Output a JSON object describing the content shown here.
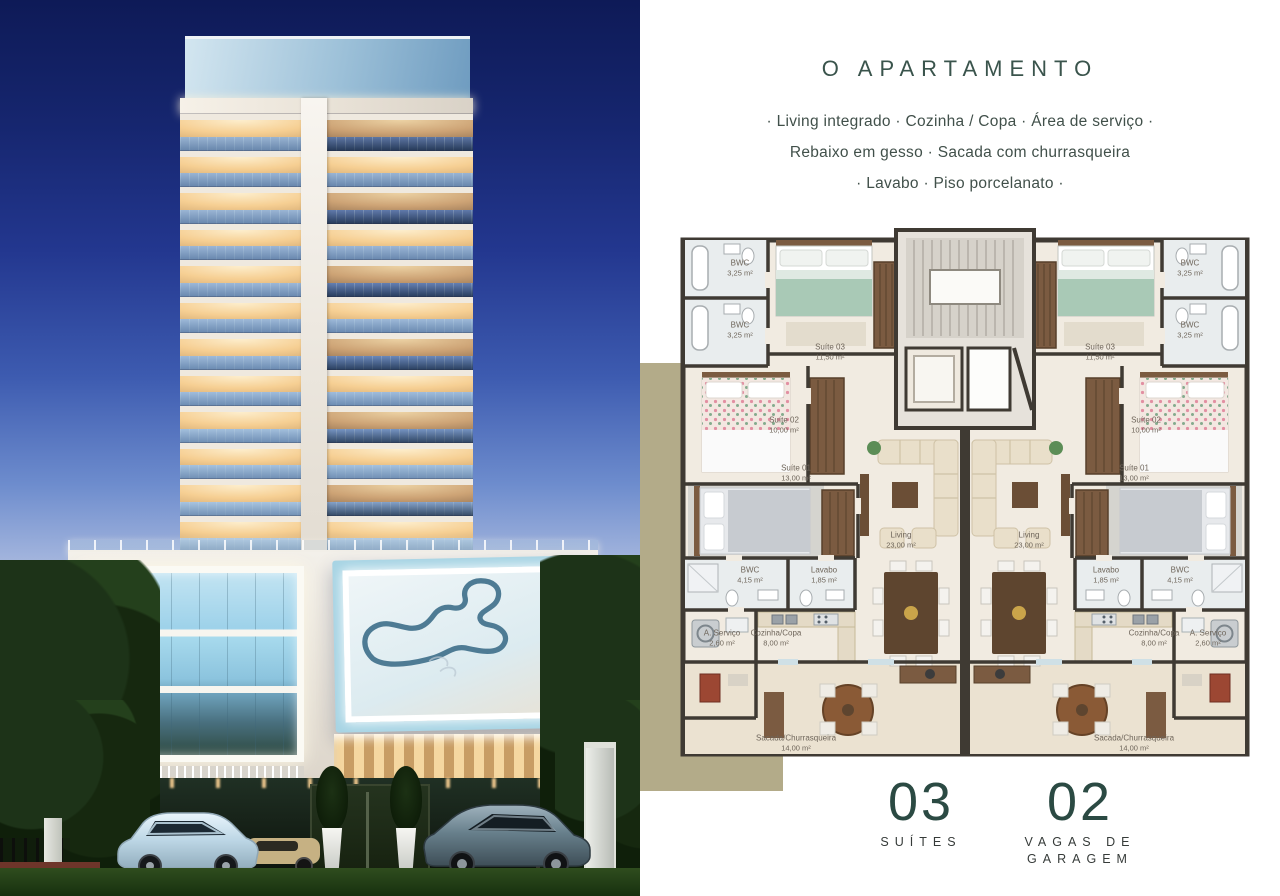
{
  "colors": {
    "accent_green": "#35544c",
    "stat_green": "#2b4a43",
    "khaki_block": "#b3ab89",
    "sky_top": "#101d5e",
    "billboard_track": "#4e7b94"
  },
  "photo": {
    "billboard_graphic": "race-track-outline"
  },
  "header": {
    "title": "O APARTAMENTO"
  },
  "features": {
    "lines": [
      "· Living integrado · Cozinha / Copa · Área de serviço ·",
      "Rebaixo em gesso · Sacada com churrasqueira",
      "· Lavabo · Piso porcelanato ·"
    ]
  },
  "floor_plan": {
    "rooms": [
      {
        "label": "BWC",
        "area": "3,25 m²"
      },
      {
        "label": "BWC",
        "area": "3,25 m²"
      },
      {
        "label": "Suíte 03",
        "area": "11,50 m²"
      },
      {
        "label": "Suíte 02",
        "area": "10,00 m²"
      },
      {
        "label": "Suíte 01",
        "area": "13,00 m²"
      },
      {
        "label": "Living",
        "area": "23,00 m²"
      },
      {
        "label": "BWC",
        "area": "4,15 m²"
      },
      {
        "label": "Lavabo",
        "area": "1,85 m²"
      },
      {
        "label": "A. Serviço",
        "area": "2,60 m²"
      },
      {
        "label": "Cozinha/Copa",
        "area": "8,00 m²"
      },
      {
        "label": "Sacada/Churrasqueira",
        "area": "14,00 m²"
      }
    ]
  },
  "stats": {
    "suites": {
      "value": "03",
      "label": "SUÍTES"
    },
    "garage": {
      "value": "02",
      "label_line1": "VAGAS DE",
      "label_line2": "GARAGEM"
    }
  }
}
